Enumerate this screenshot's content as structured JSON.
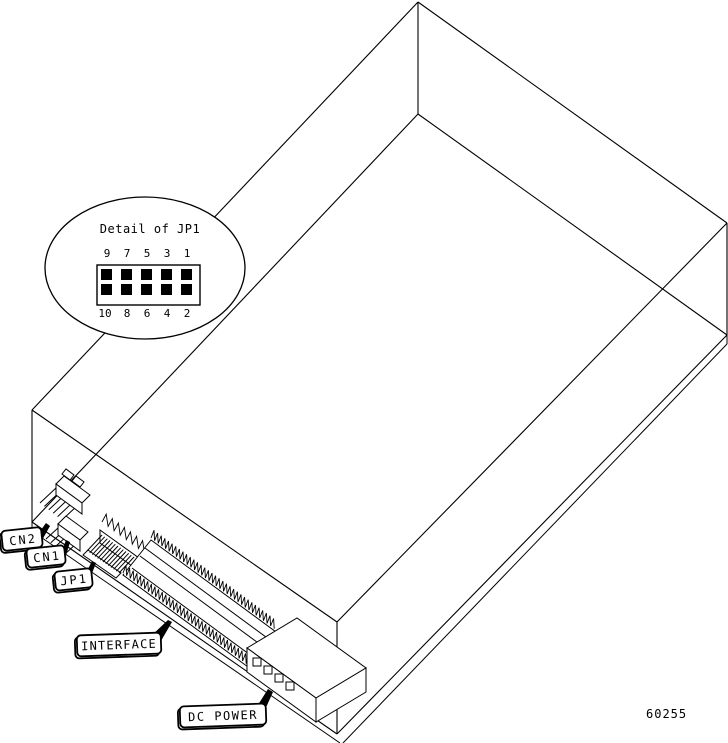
{
  "figure": {
    "figure_number": "60255",
    "colors": {
      "line": "#000000",
      "background": "#ffffff"
    },
    "balloon": {
      "title": "Detail of JP1",
      "pins_top": [
        "9",
        "7",
        "5",
        "3",
        "1"
      ],
      "pins_bottom": [
        "10",
        "8",
        "6",
        "4",
        "2"
      ]
    },
    "callouts": {
      "cn2": "CN2",
      "cn1": "CN1",
      "jp1": "JP1",
      "interface": "INTERFACE",
      "dc_power": "DC POWER"
    }
  }
}
